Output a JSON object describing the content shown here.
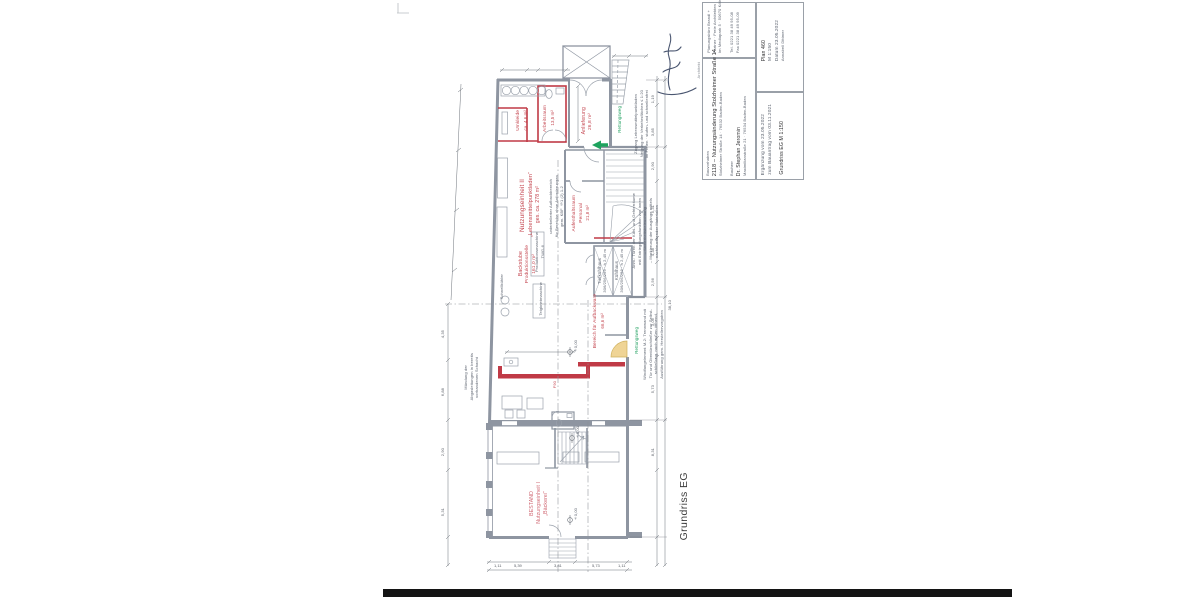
{
  "sheet": {
    "drawing_label": "Grundriss EG",
    "architect_box": {
      "c1": "Planungsbüro Brandl +",
      "c2": "Partner · Freie Architekten",
      "c3": "Im Mediapark 5 · 50670 Köln",
      "c4": "Tel. 0221 38 49 95-08",
      "c5": "Fax 0221 38 49 95-09"
    },
    "project_box": {
      "label1": "Bauvorhaben",
      "title": "2118 – Nutzungsänderung Stolzheimer Straße 14",
      "address": "Stolzheimer Straße 14 · 76532 Baden-Baden",
      "label2": "Bauherr",
      "client": "Dr. Stephan Jeromin",
      "client_address": "Maximilianstraße 21 · 76534 Baden-Baden"
    },
    "meta_box": {
      "plan_no": "Plan 460",
      "scale": "M 1:150",
      "date": "Datum 23.05.2022",
      "author": "Annabell Dittmer"
    },
    "revision_box": {
      "line1": "Ergänzung vom 23.05.2022",
      "line2": "zum Bauantrag vom 03.11.2021",
      "line3": "Grundriss EG       M 1:150"
    },
    "signature_caption": "Architekt"
  },
  "plan": {
    "rooms": {
      "umkleide": {
        "l1": "Umkleide",
        "l2": "ca. 4,6 m²"
      },
      "arbeitsraum": {
        "l1": "Arbeitsraum",
        "l2": "13,5 m²"
      },
      "anlieferung": {
        "l1": "Anlieferung",
        "l2": "26,8 m²"
      },
      "unit2": {
        "l1": "Nutzungseinheit II",
        "l2": "„Lebensmittelpunktladen“",
        "l3": "ges. ca. 278 m²"
      },
      "aufenthalt": {
        "l1": "Aufenthaltsraum",
        "l2": "Personal",
        "l3": "21,8 m²"
      },
      "tiefkuehl": {
        "l1": "Tiefkühlhaus",
        "l2": "306/256/256 · h 2,45 m"
      },
      "kuehl": {
        "l1": "Kühlhaus",
        "l2": "306/256/256 · h 2,45 m"
      },
      "backstube": {
        "l1": "Backstube",
        "l2": "Produktionsstelle",
        "l3": "161,0 m²"
      },
      "verkauf": {
        "l1": "Bereich für Aufbackware",
        "l2": "66,6 m²"
      },
      "bestand": {
        "l1": "BESTAND",
        "l2": "Nutzungseinheit I",
        "l3": "„Bäckerei“"
      }
    },
    "labels": {
      "prodmaschine": {
        "l1": "Produktionsmaschine",
        "l2": "TWG-6"
      },
      "schnellkuehler": "Schnellkühler",
      "teigknet": "Teigknetmaschine",
      "rettungsweg": "Rettungsweg",
      "f90": "F90",
      "level": "±0,00"
    },
    "notes": {
      "abgas": {
        "l1": "Mündung der",
        "l2": "Abgasleitungen in bereits",
        "l3": "vorhandenen Schacht"
      },
      "kuehltueren": {
        "l1": "Anm.: Türen der Kühl- und Gefrierräume",
        "l2": "mit Entriegelungsfunktion von innen",
        "l3": "– Sicherheitsbeleuchtung",
        "l4": "– Markierung der Ausgänge mittels",
        "l5": "nachleuchtender Materialien"
      },
      "zugang": {
        "l1": "Zugang Lebensmittelpunktladen",
        "l2": "Neigung der Verkehrsflächen ≤ 1:20",
        "l3": "im Freien · stufen- und schwellenfrei"
      },
      "windfang": {
        "l1": "Windfangelement M-2: Trennwand mit",
        "l2": "Tür und Obentürschließer zur Selbst-",
        "l3": "schließung, nach außen öffnend,",
        "l4": "Ausführung gem. Herstellervorgaben"
      },
      "aufback": {
        "l1": "unterkellerter Aufbackbereich",
        "l2": "für Bereiche ohne Anforderungen",
        "l3": "gem. KBF §1 (2) 1-2"
      }
    },
    "dims": {
      "right": [
        "1,19",
        "3,85",
        "2,90",
        "5,31",
        "4,38",
        "2,56",
        "3,06",
        "5,73",
        "8,31",
        "38,10"
      ],
      "left": [
        "4,35",
        "6,88",
        "2,90",
        "5,31"
      ],
      "bottom": [
        "1,11",
        "5,39",
        "3,81",
        "5,73",
        "1,11"
      ]
    },
    "colors": {
      "new_red": "#c03a46",
      "green": "#1ea35e",
      "door_yellow": "#eed08a",
      "wall_gray": "#8e95a1"
    }
  }
}
